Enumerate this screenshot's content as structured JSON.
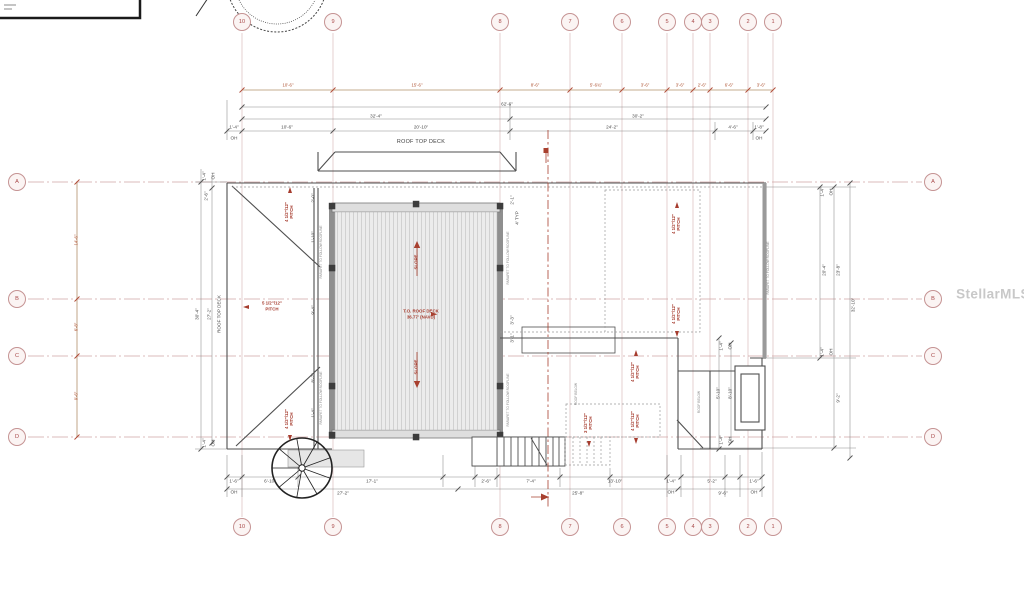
{
  "watermark": {
    "text": "StellarMLS"
  },
  "grid": {
    "columns": [
      {
        "label": "10",
        "x": 242
      },
      {
        "label": "9",
        "x": 333
      },
      {
        "label": "8",
        "x": 500
      },
      {
        "label": "7",
        "x": 570
      },
      {
        "label": "6",
        "x": 622
      },
      {
        "label": "5",
        "x": 667
      },
      {
        "label": "4",
        "x": 693
      },
      {
        "label": "3",
        "x": 710
      },
      {
        "label": "2",
        "x": 748
      },
      {
        "label": "1",
        "x": 773
      }
    ],
    "rows": [
      {
        "label": "A",
        "y": 182
      },
      {
        "label": "B",
        "y": 299
      },
      {
        "label": "C",
        "y": 356
      },
      {
        "label": "D",
        "y": 437
      }
    ],
    "bubble_top_y": 22,
    "bubble_bottom_y": 527,
    "bubble_left_x": 17,
    "bubble_right_x": 933
  },
  "colors": {
    "grid_pink": "#cfa5a5",
    "red_annotation": "#a63c2e",
    "red_dim": "#ad5130",
    "black_dim": "#4a4a4a",
    "hatch_fill": "#ececec"
  },
  "annotations": [
    {
      "t": "10'-6\"",
      "x": 288,
      "y": 86,
      "c": "r2",
      "n": "red-dim-top"
    },
    {
      "t": "15'-6\"",
      "x": 417,
      "y": 86,
      "c": "r2",
      "n": "red-dim-top"
    },
    {
      "t": "8'-6\"",
      "x": 535,
      "y": 86,
      "c": "r2",
      "n": "red-dim-top"
    },
    {
      "t": "5'-6¾\"",
      "x": 596,
      "y": 86,
      "c": "r2",
      "n": "red-dim-top"
    },
    {
      "t": "3'-6\"",
      "x": 645,
      "y": 86,
      "c": "r2",
      "n": "red-dim-top"
    },
    {
      "t": "3'-6\"",
      "x": 680,
      "y": 86,
      "c": "r2",
      "n": "red-dim-top"
    },
    {
      "t": "2'-6\"",
      "x": 702,
      "y": 86,
      "c": "r2",
      "n": "red-dim-top"
    },
    {
      "t": "6'-6\"",
      "x": 729,
      "y": 86,
      "c": "r2",
      "n": "red-dim-top"
    },
    {
      "t": "3'-6\"",
      "x": 761,
      "y": 86,
      "c": "r2",
      "n": "red-dim-top"
    },
    {
      "t": "14'-6\"",
      "x": 77,
      "y": 240,
      "c": "rr2",
      "n": "red-dim-left"
    },
    {
      "t": "6'-8\"",
      "x": 77,
      "y": 327,
      "c": "rr2",
      "n": "red-dim-left"
    },
    {
      "t": "9'-6\"",
      "x": 77,
      "y": 396,
      "c": "rr2",
      "n": "red-dim-left"
    },
    {
      "t": "62'-6\"",
      "x": 507,
      "y": 104,
      "c": "d",
      "n": "dimension-label"
    },
    {
      "t": "32'-4\"",
      "x": 376,
      "y": 116,
      "c": "d",
      "n": "dimension-label"
    },
    {
      "t": "30'-2\"",
      "x": 638,
      "y": 116,
      "c": "d",
      "n": "dimension-label"
    },
    {
      "t": "1'-4\"",
      "x": 234,
      "y": 127,
      "c": "d",
      "n": "dimension-label"
    },
    {
      "t": "10'-6\"",
      "x": 287,
      "y": 127,
      "c": "d",
      "n": "dimension-label"
    },
    {
      "t": "20'-10\"",
      "x": 421,
      "y": 127,
      "c": "d",
      "n": "dimension-label"
    },
    {
      "t": "24'-2\"",
      "x": 612,
      "y": 127,
      "c": "d",
      "n": "dimension-label"
    },
    {
      "t": "4'-6\"",
      "x": 733,
      "y": 127,
      "c": "d",
      "n": "dimension-label"
    },
    {
      "t": "1'-8\"",
      "x": 759,
      "y": 127,
      "c": "d",
      "n": "dimension-label"
    },
    {
      "t": "OH",
      "x": 234,
      "y": 138,
      "c": "d",
      "n": "overhang-label"
    },
    {
      "t": "OH",
      "x": 759,
      "y": 138,
      "c": "d",
      "n": "overhang-label"
    },
    {
      "t": "ROOF TOP DECK",
      "x": 421,
      "y": 143,
      "c": "n",
      "n": "roof-top-deck-label"
    },
    {
      "t": "1'-6\"",
      "x": 234,
      "y": 481,
      "c": "d",
      "n": "dimension-label"
    },
    {
      "t": "6'-10\"",
      "x": 270,
      "y": 481,
      "c": "d",
      "n": "dimension-label"
    },
    {
      "t": "17'-1\"",
      "x": 372,
      "y": 481,
      "c": "d",
      "n": "dimension-label"
    },
    {
      "t": "2'-6\"",
      "x": 486,
      "y": 481,
      "c": "d",
      "n": "dimension-label"
    },
    {
      "t": "7'-4\"",
      "x": 531,
      "y": 481,
      "c": "d",
      "n": "dimension-label"
    },
    {
      "t": "13'-10\"",
      "x": 615,
      "y": 481,
      "c": "d",
      "n": "dimension-label"
    },
    {
      "t": "1'-4\"",
      "x": 671,
      "y": 481,
      "c": "d",
      "n": "dimension-label"
    },
    {
      "t": "5'-2\"",
      "x": 712,
      "y": 481,
      "c": "d",
      "n": "dimension-label"
    },
    {
      "t": "1'-6\"",
      "x": 754,
      "y": 481,
      "c": "d",
      "n": "dimension-label"
    },
    {
      "t": "OH",
      "x": 234,
      "y": 492,
      "c": "d",
      "n": "overhang-label"
    },
    {
      "t": "OH",
      "x": 671,
      "y": 492,
      "c": "d",
      "n": "overhang-label"
    },
    {
      "t": "OH",
      "x": 754,
      "y": 492,
      "c": "d",
      "n": "overhang-label"
    },
    {
      "t": "27'-2\"",
      "x": 343,
      "y": 493,
      "c": "d",
      "n": "dimension-label"
    },
    {
      "t": "25'-8\"",
      "x": 578,
      "y": 493,
      "c": "d",
      "n": "dimension-label"
    },
    {
      "t": "9'-6\"",
      "x": 723,
      "y": 493,
      "c": "d",
      "n": "dimension-label"
    },
    {
      "t": "1'-4\"",
      "x": 204,
      "y": 176,
      "c": "dr",
      "n": "dimension-label"
    },
    {
      "t": "OH",
      "x": 213,
      "y": 176,
      "c": "dr",
      "n": "overhang-label"
    },
    {
      "t": "2'-6\"",
      "x": 206,
      "y": 196,
      "c": "dr",
      "n": "dimension-label"
    },
    {
      "t": "30'-4\"",
      "x": 197,
      "y": 314,
      "c": "dr",
      "n": "dimension-label"
    },
    {
      "t": "27'-2\"",
      "x": 209,
      "y": 314,
      "c": "dr",
      "n": "dimension-label"
    },
    {
      "t": "ROOF TOP DECK",
      "x": 219,
      "y": 314,
      "c": "dr",
      "n": "roof-top-deck-side-label"
    },
    {
      "t": "1'-4\"",
      "x": 204,
      "y": 443,
      "c": "dr",
      "n": "dimension-label"
    },
    {
      "t": "OH",
      "x": 213,
      "y": 443,
      "c": "dr",
      "n": "overhang-label"
    },
    {
      "t": "2'-0\"",
      "x": 313,
      "y": 198,
      "c": "dr",
      "n": "dimension-label"
    },
    {
      "t": "1'-10\"",
      "x": 313,
      "y": 237,
      "c": "dr",
      "n": "dimension-label"
    },
    {
      "t": "9'-4\"",
      "x": 313,
      "y": 310,
      "c": "dr",
      "n": "dimension-label"
    },
    {
      "t": "8'-2\"",
      "x": 313,
      "y": 378,
      "c": "dr",
      "n": "dimension-label"
    },
    {
      "t": "1'-4\"",
      "x": 313,
      "y": 413,
      "c": "dr",
      "n": "dimension-label"
    },
    {
      "t": "2'-1\"",
      "x": 512,
      "y": 200,
      "c": "dr",
      "n": "dimension-label"
    },
    {
      "t": "4' TYP",
      "x": 517,
      "y": 218,
      "c": "dr",
      "n": "dimension-label"
    },
    {
      "t": "3'-3\"",
      "x": 512,
      "y": 320,
      "c": "dr",
      "n": "dimension-label"
    },
    {
      "t": "3'-1\"",
      "x": 512,
      "y": 338,
      "c": "dr",
      "n": "dimension-label"
    },
    {
      "t": "1'-4\"",
      "x": 822,
      "y": 192,
      "c": "dr",
      "n": "dimension-label"
    },
    {
      "t": "OH",
      "x": 831,
      "y": 192,
      "c": "dr",
      "n": "overhang-label"
    },
    {
      "t": "20'-4\"",
      "x": 824,
      "y": 270,
      "c": "dr",
      "n": "dimension-label"
    },
    {
      "t": "23'-8\"",
      "x": 838,
      "y": 270,
      "c": "dr",
      "n": "dimension-label"
    },
    {
      "t": "32'-10\"",
      "x": 853,
      "y": 305,
      "c": "dr",
      "n": "dimension-label"
    },
    {
      "t": "1'-4\"",
      "x": 822,
      "y": 352,
      "c": "dr",
      "n": "dimension-label"
    },
    {
      "t": "OH",
      "x": 831,
      "y": 352,
      "c": "dr",
      "n": "overhang-label"
    },
    {
      "t": "9'-2\"",
      "x": 838,
      "y": 398,
      "c": "dr",
      "n": "dimension-label"
    },
    {
      "t": "1'-4\"",
      "x": 721,
      "y": 346,
      "c": "dr",
      "n": "dimension-label"
    },
    {
      "t": "OH",
      "x": 730,
      "y": 346,
      "c": "dr",
      "n": "overhang-label"
    },
    {
      "t": "5'-10\"",
      "x": 718,
      "y": 393,
      "c": "dr",
      "n": "dimension-label"
    },
    {
      "t": "8'-10\"",
      "x": 730,
      "y": 393,
      "c": "dr",
      "n": "dimension-label"
    },
    {
      "t": "1'-4\"",
      "x": 721,
      "y": 440,
      "c": "dr",
      "n": "dimension-label"
    },
    {
      "t": "OH",
      "x": 730,
      "y": 440,
      "c": "dr",
      "n": "overhang-label"
    },
    {
      "t": "PARAPET TO FOLLOW ROOFLINE",
      "x": 322,
      "y": 252,
      "c": "gr",
      "n": "parapet-note"
    },
    {
      "t": "PARAPET TO FOLLOW ROOFLINE",
      "x": 322,
      "y": 398,
      "c": "gr",
      "n": "parapet-note"
    },
    {
      "t": "PARAPET TO FOLLOW ROOFLINE",
      "x": 509,
      "y": 258,
      "c": "gr",
      "n": "parapet-note"
    },
    {
      "t": "PARAPET TO FOLLOW ROOFLINE",
      "x": 509,
      "y": 400,
      "c": "gr",
      "n": "parapet-note"
    },
    {
      "t": "PARAPET TO FOLLOW ROOFLINE",
      "x": 769,
      "y": 268,
      "c": "gr",
      "n": "parapet-note"
    },
    {
      "t": "ROOF BELOW",
      "x": 700,
      "y": 402,
      "c": "gr",
      "n": "roof-below-note"
    },
    {
      "t": "ROOF BELOW",
      "x": 577,
      "y": 394,
      "c": "gr",
      "n": "roof-below-note"
    },
    {
      "t": "T.O. ROOF DECK",
      "x": 421,
      "y": 312,
      "c": "r",
      "n": "top-of-roof-deck-label"
    },
    {
      "t": "36.77' (NAVD)",
      "x": 421,
      "y": 318,
      "c": "r",
      "n": "roof-deck-elevation"
    },
    {
      "t": "5 1/2\"/12\"",
      "x": 272,
      "y": 304,
      "c": "r",
      "n": "pitch-label"
    },
    {
      "t": "PITCH",
      "x": 272,
      "y": 310,
      "c": "r",
      "n": "pitch-label"
    },
    {
      "t": "4 1/2\"/12\"\nPITCH",
      "x": 290,
      "y": 212,
      "c": "rr",
      "n": "pitch-label"
    },
    {
      "t": "4 1/2\"/12\"\nPITCH",
      "x": 290,
      "y": 419,
      "c": "rr",
      "n": "pitch-label"
    },
    {
      "t": "4 1/2\"/12\"\nPITCH",
      "x": 677,
      "y": 224,
      "c": "rr",
      "n": "pitch-label"
    },
    {
      "t": "4 1/2\"/12\"\nPITCH",
      "x": 677,
      "y": 314,
      "c": "rr",
      "n": "pitch-label"
    },
    {
      "t": "4 1/2\"/12\"\nPITCH",
      "x": 636,
      "y": 372,
      "c": "rr",
      "n": "pitch-label"
    },
    {
      "t": "4 1/2\"/12\"\nPITCH",
      "x": 636,
      "y": 421,
      "c": "rr",
      "n": "pitch-label"
    },
    {
      "t": "3 1/2\"/12\"\nPITCH",
      "x": 589,
      "y": 423,
      "c": "rr",
      "n": "pitch-label"
    },
    {
      "t": "SLOPE",
      "x": 417,
      "y": 262,
      "c": "rr",
      "n": "slope-label"
    },
    {
      "t": "SLOPE",
      "x": 417,
      "y": 367,
      "c": "rr",
      "n": "slope-label"
    },
    {
      "t": "",
      "x": 290,
      "y": 190,
      "c": "au",
      "n": "pitch-arrow-up"
    },
    {
      "t": "",
      "x": 290,
      "y": 438,
      "c": "ad",
      "n": "pitch-arrow-down"
    },
    {
      "t": "",
      "x": 677,
      "y": 205,
      "c": "au",
      "n": "pitch-arrow-up"
    },
    {
      "t": "",
      "x": 677,
      "y": 334,
      "c": "ad",
      "n": "pitch-arrow-down"
    },
    {
      "t": "",
      "x": 636,
      "y": 353,
      "c": "au",
      "n": "pitch-arrow-up"
    },
    {
      "t": "",
      "x": 636,
      "y": 441,
      "c": "ad",
      "n": "pitch-arrow-down"
    },
    {
      "t": "",
      "x": 589,
      "y": 444,
      "c": "ad",
      "n": "pitch-arrow-down"
    },
    {
      "t": "",
      "x": 246,
      "y": 307,
      "c": "al",
      "n": "pitch-arrow-left"
    }
  ]
}
